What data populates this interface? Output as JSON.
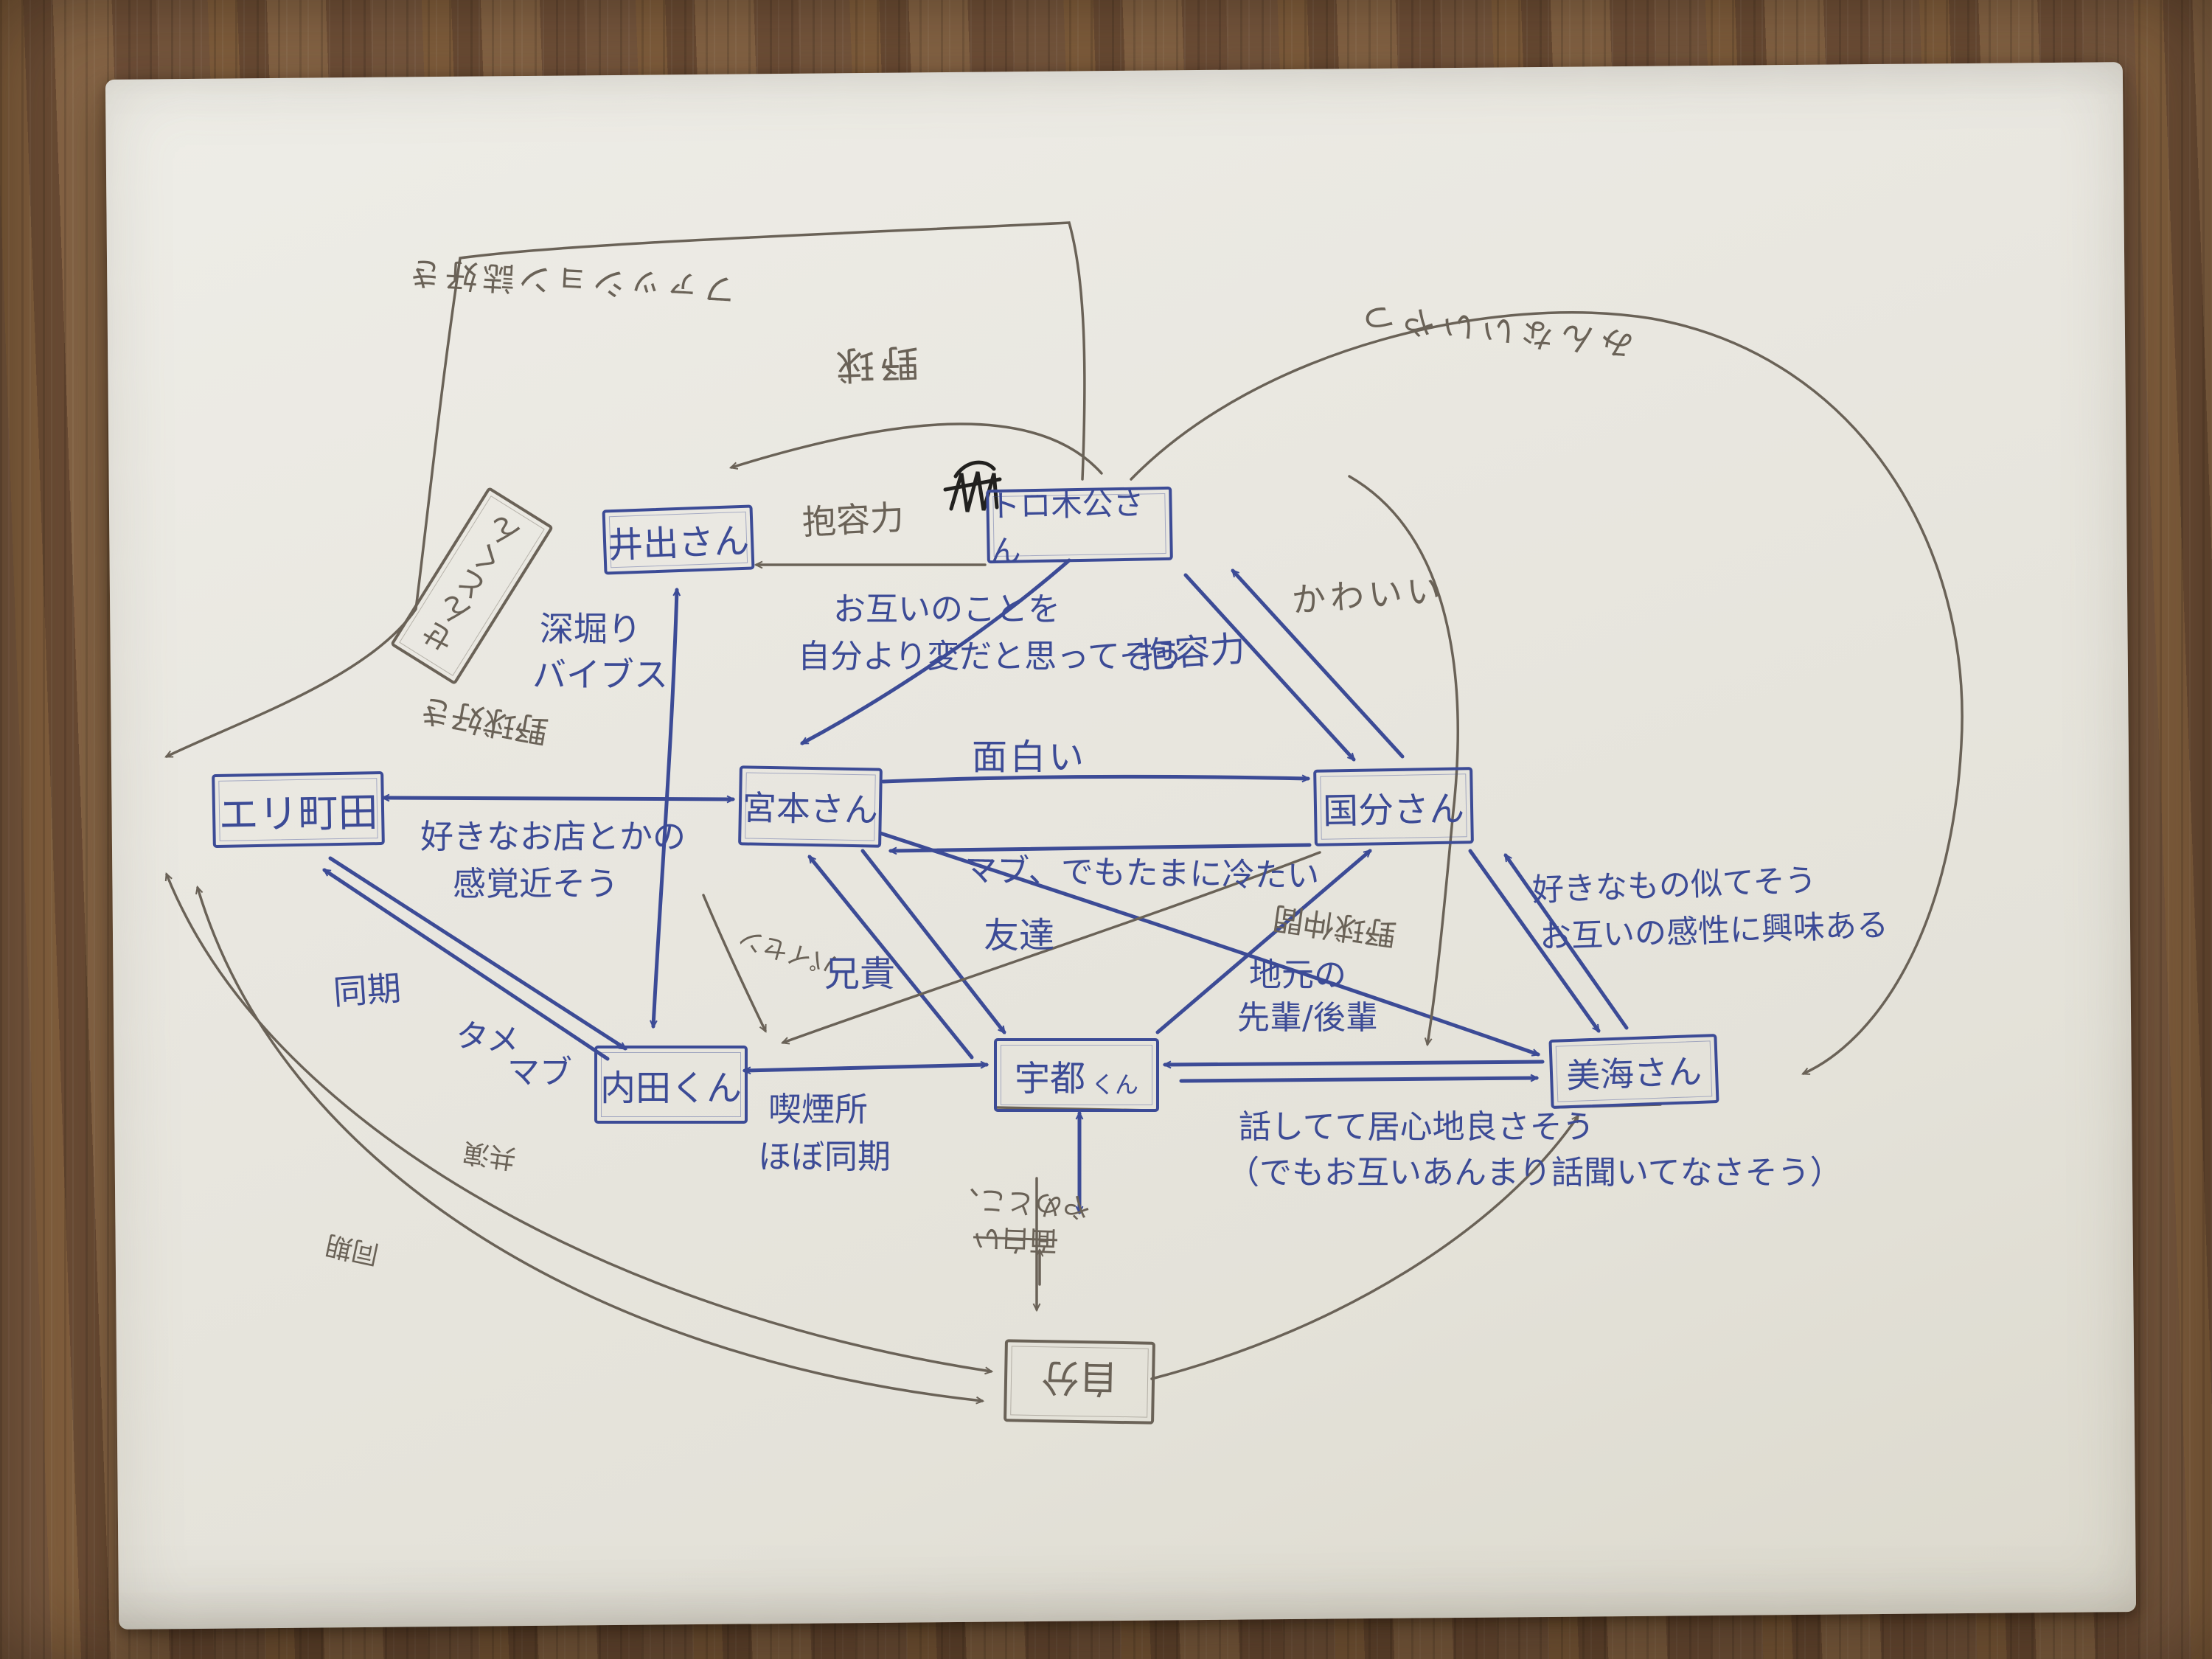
{
  "colors": {
    "ink_blue": "#3c4b96",
    "pencil_grey": "#6a6257",
    "black_ink": "#22211f",
    "paper": "#e9e7e0",
    "wood": "#7a5a40"
  },
  "nodes": {
    "eri": "エリ町田",
    "ide": "井出さん",
    "toro": "トロ木公さん",
    "sento": "せんとくん",
    "miyamoto": "宮本さん",
    "kokubu": "国分さん",
    "uchida": "内田くん",
    "uto_main": "宇都",
    "uto_suffix": "くん",
    "minami": "美海さん",
    "jibun": "自分"
  },
  "labels": {
    "fashion_flip": "ファッション誌好き",
    "yakyu_flip": "野球",
    "iiyatsu_flip": "みんないいやつ",
    "houyou_pencil": "抱容力",
    "fukabori1": "深堀り",
    "fukabori2": "バイブス",
    "otagai1": "お互いのことを",
    "otagai2": "自分より変だと思ってそう",
    "houyou_blue": "抱容力",
    "kawaii": "かわいい",
    "omoshiroi": "面白い",
    "mabu_tsumetai": "マブ、でもたまに冷たい",
    "sukina_mono1": "好きなもの似てそう",
    "sukina_mono2": "お互いの感性に興味ある",
    "sukina_omise1": "好きなお店とかの",
    "sukina_omise2": "感覚近そう",
    "yakyuzuki_flip": "野球好き",
    "paisen_flip": "パイセン",
    "aniki": "兄貴",
    "tomodachi": "友達",
    "yakyu_nakama_flip": "野球仲間",
    "jimoto1": "地元の",
    "jimoto2": "先輩/後輩",
    "douki": "同期",
    "tame": "タメ",
    "mabu": "マブ",
    "kitsuen1": "喫煙所",
    "kitsuen2": "ほぼ同期",
    "igokochi1": "話してて居心地良さそう",
    "igokochi2": "（でもお互いあんまり話聞いてなさそう）",
    "kyouen_flip": "共演",
    "douki2_flip": "同期",
    "yametoko_flip": "やめとこ、",
    "omoshiroi_strike_flip": "面白い"
  }
}
